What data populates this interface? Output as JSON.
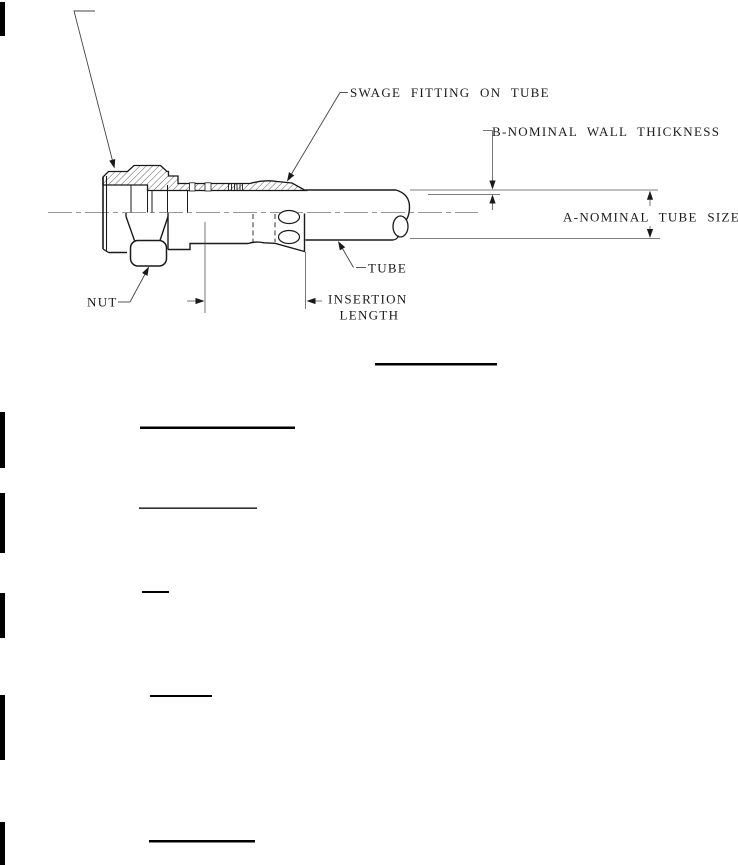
{
  "page": {
    "background": "#ffffff",
    "line_color": "#1a1a1a",
    "thin_line_color": "#555555"
  },
  "figure": {
    "type": "technical-line-drawing",
    "labels": {
      "swage_fitting": "SWAGE FITTING ON TUBE",
      "wall_thickness": "B-NOMINAL WALL THICKNESS",
      "tube_size": "A-NOMINAL TUBE SIZE",
      "tube": "TUBE",
      "nut": "NUT",
      "insertion_line1": "INSERTION",
      "insertion_line2": "LENGTH"
    }
  }
}
